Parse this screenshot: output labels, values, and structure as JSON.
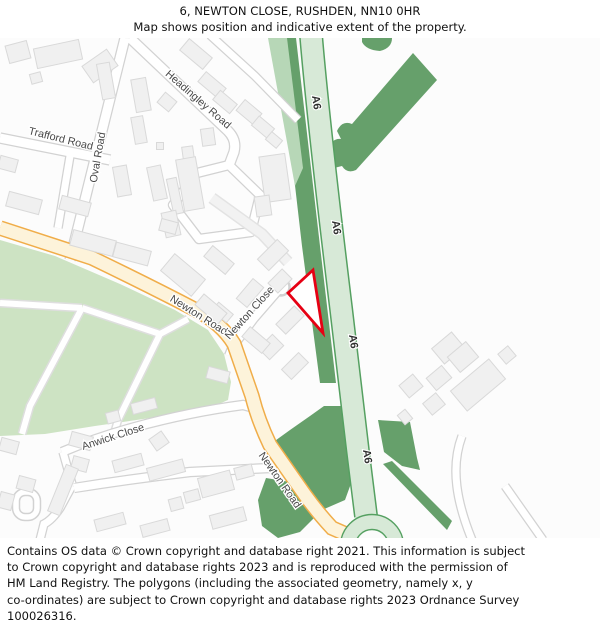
{
  "title": {
    "line1": "6, NEWTON CLOSE, RUSHDEN, NN10 0HR",
    "line2": "Map shows position and indicative extent of the property."
  },
  "map": {
    "road_labels": {
      "trafford": "Trafford Road",
      "oval": "Oval Road",
      "headingley": "Headingley Road",
      "newton_road_upper": "Newton Road",
      "newton_close": "Newton Close",
      "anwick": "Anwick Close",
      "newton_road_lower": "Newton Road",
      "a6": "A6"
    },
    "colors": {
      "property_outline": "#e60013",
      "a_road_fill": "#d7e9d7",
      "a_road_casing": "#55a061",
      "woodland": "#66a06b",
      "woodland_light": "#b7d7b7",
      "park": "#cde3c3",
      "secondary_road_fill": "#fdf3da",
      "secondary_road_casing": "#f0ad49",
      "building_fill": "#f0f0f0",
      "map_background": "#fcfcfc"
    }
  },
  "footer": {
    "lines": [
      "Contains OS data © Crown copyright and database right 2021. This information is subject",
      "to Crown copyright and database rights 2023 and is reproduced with the permission of",
      "HM Land Registry. The polygons (including the associated geometry, namely x, y",
      "co-ordinates) are subject to Crown copyright and database rights 2023 Ordnance Survey",
      "100026316."
    ]
  }
}
